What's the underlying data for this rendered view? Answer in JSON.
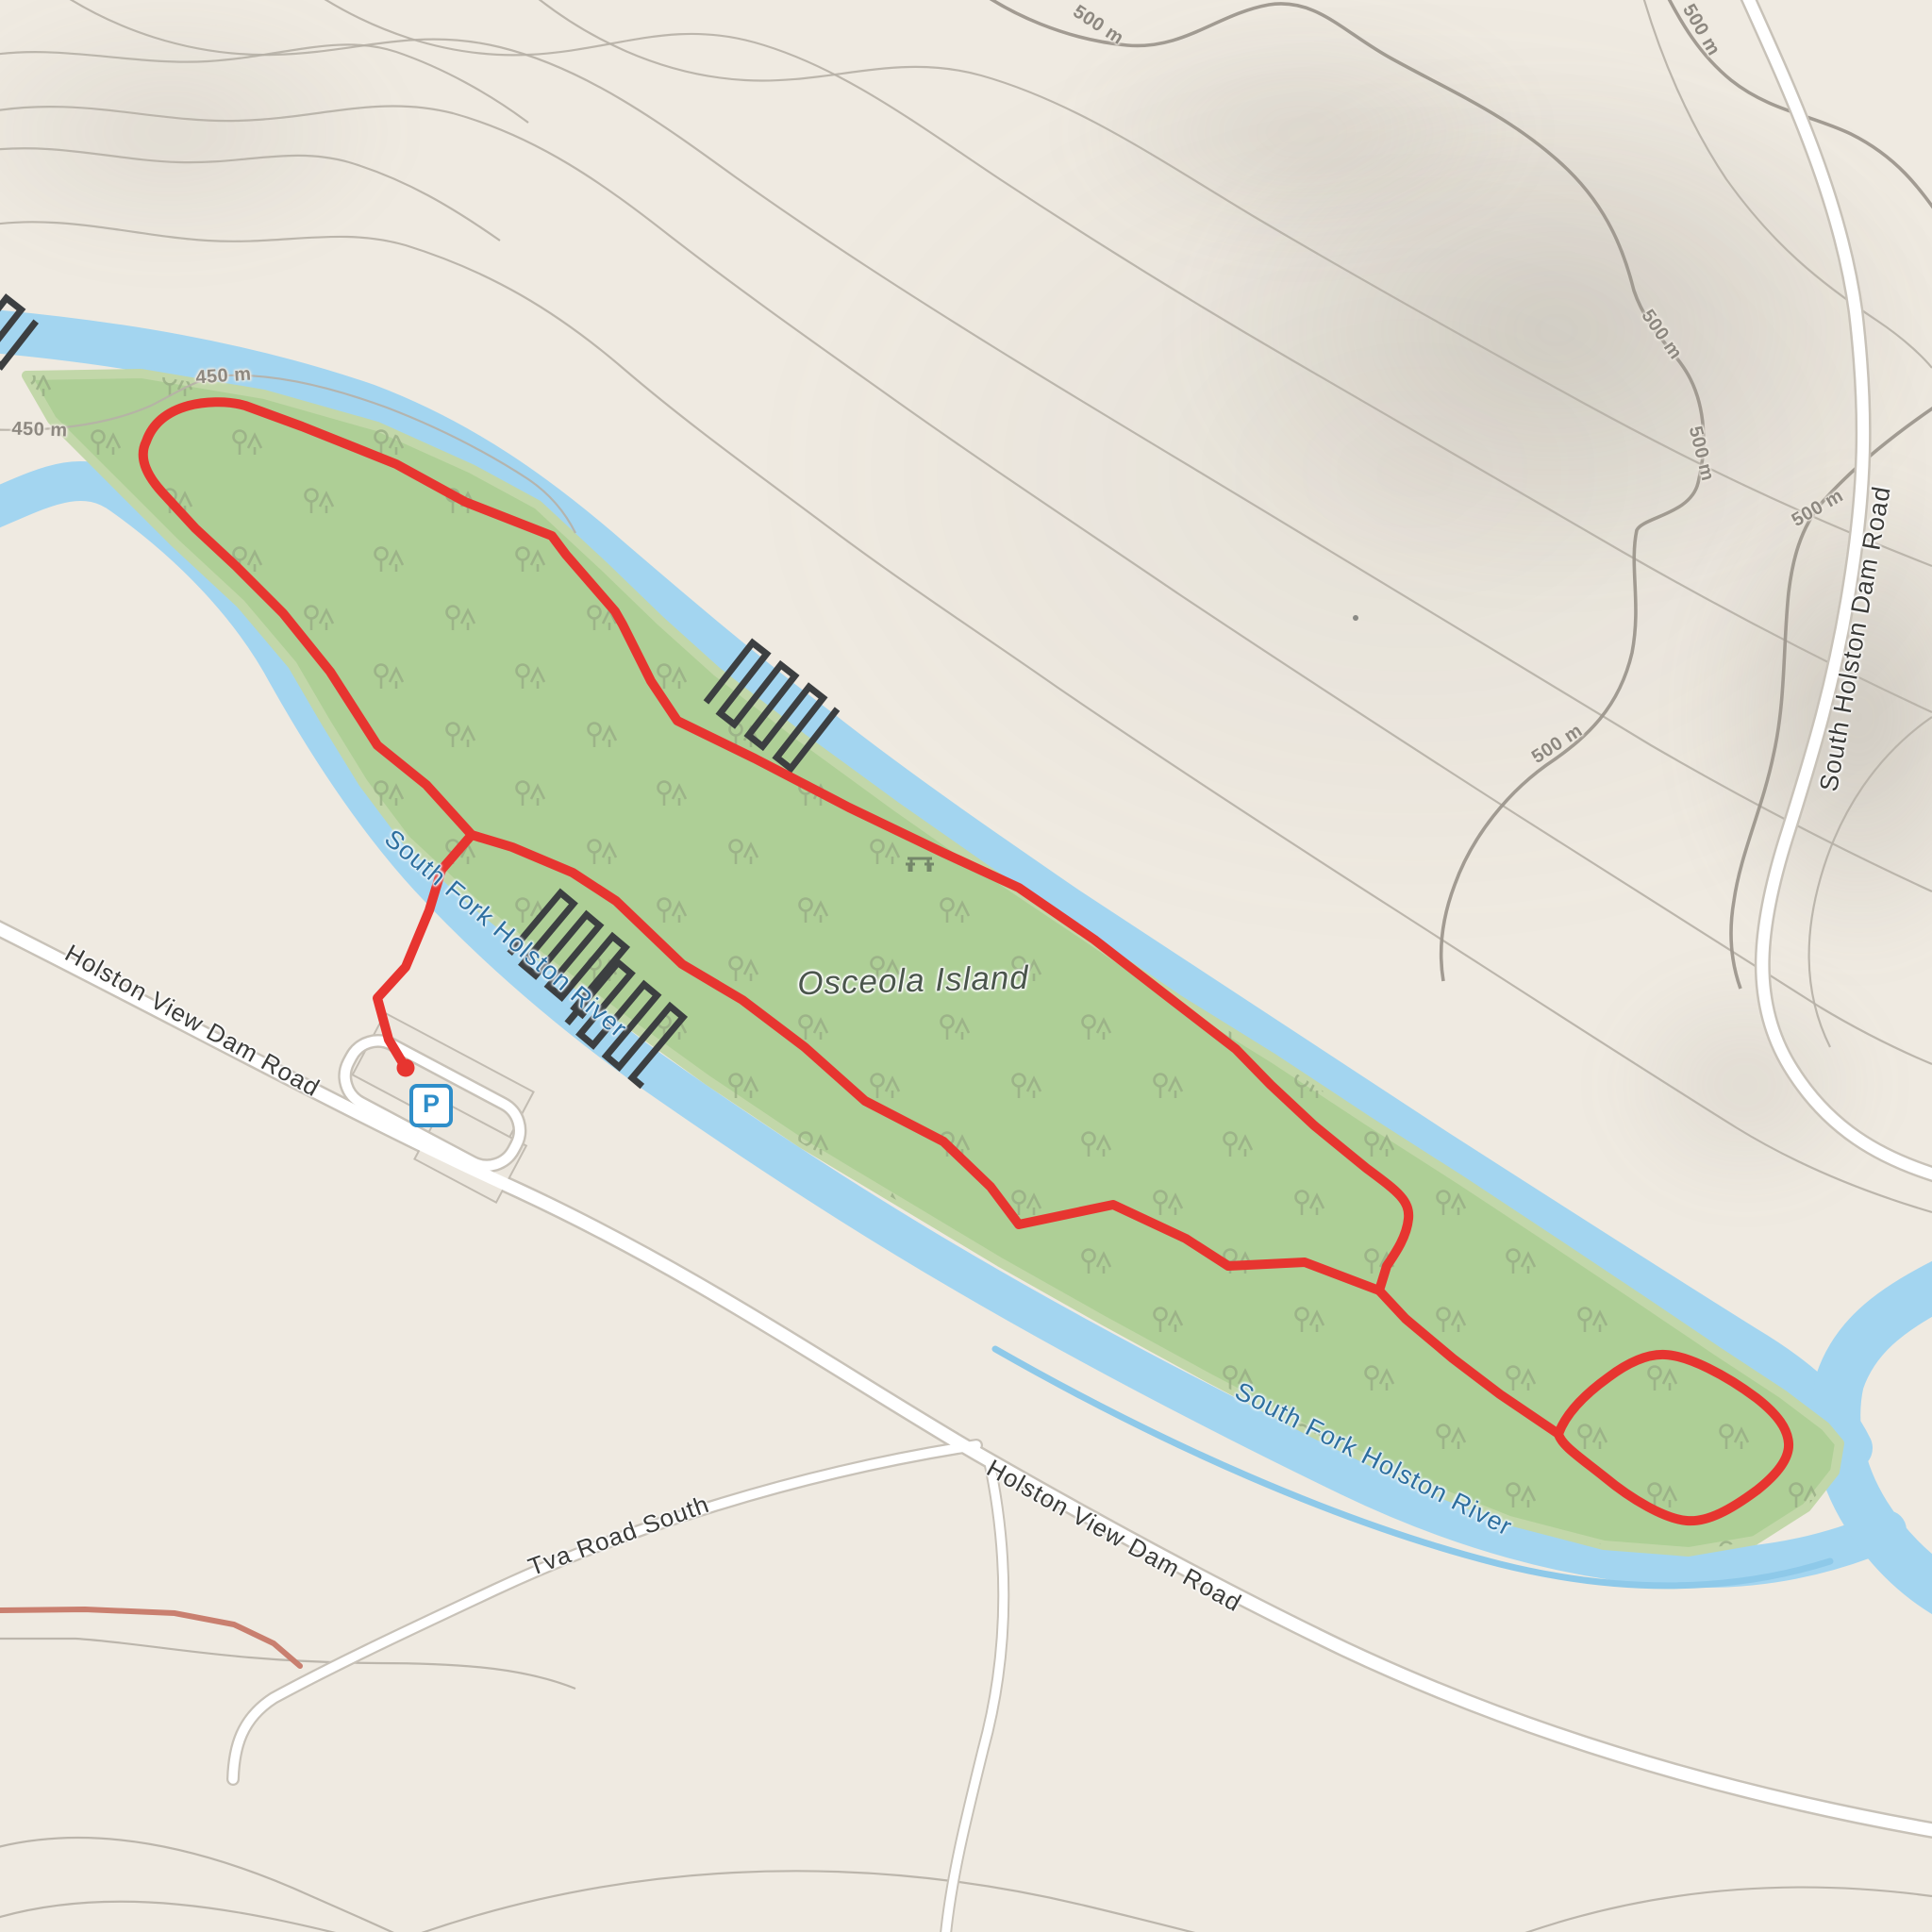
{
  "map": {
    "island_label": "Osceola Island",
    "river_label_upper": "South Fork Holston River",
    "river_label_lower": "South Fork Holston River",
    "road_label_holston_view_upper": "Holston View Dam Road",
    "road_label_holston_view_lower": "Holston View Dam Road",
    "road_label_tva": "Tva Road South",
    "road_label_south_holston_dam": "South Holston Dam Road",
    "parking_icon_label": "P",
    "contour_labels": {
      "c450_west_upper": "450 m",
      "c450_west_lower": "450 m",
      "c500_top_center": "500 m",
      "c500_top_right": "500 m",
      "c500_mid_upper": "500 m",
      "c500_mid_lower": "500 m",
      "c500_right": "500 m",
      "c500_lower": "500 m"
    }
  },
  "colors": {
    "land": "#efeae1",
    "forest": "#aecf96",
    "water": "#a3d5f0",
    "stream": "#8ec9e9",
    "trail": "#e73530",
    "road_fill": "#ffffff",
    "road_casing": "#c8c2b8",
    "contour": "#b6b0a6",
    "contour_index": "#9d978d",
    "contour_label": "#8d8880",
    "river_label": "#2e6f9f",
    "road_label": "#3b3b38",
    "place_label": "#4b564c",
    "parking_blue": "#2f8ec9",
    "weir": "#3c3f41",
    "tree": "#97ac85",
    "track": "#c97f6f"
  }
}
